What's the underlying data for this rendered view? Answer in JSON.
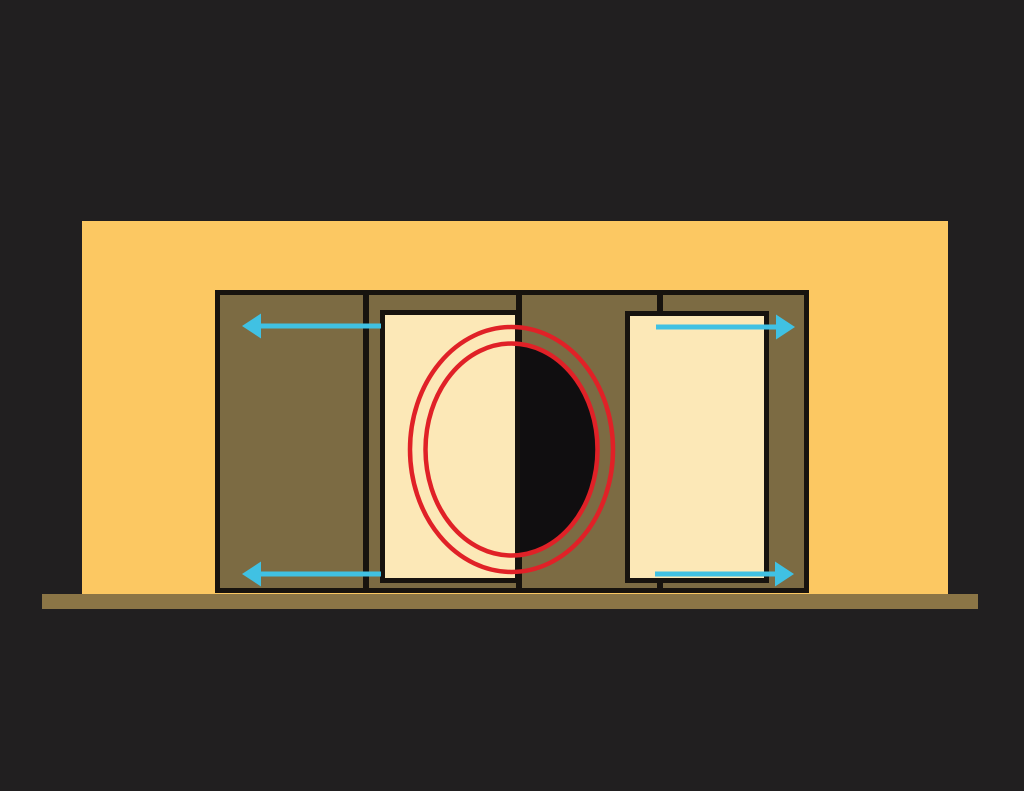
{
  "scene": {
    "canvas": {
      "width": 1024,
      "height": 791,
      "background": "#211f20"
    },
    "palette": {
      "background": "#211f20",
      "wall": "#fcc862",
      "outline": "#17130e",
      "frame_fill": "#7c6b43",
      "panel_fill": "#fce8b7",
      "floor": "#8b7546",
      "gap_shadow": "#100e10",
      "ring": "#e02127",
      "arrow": "#40c1e3"
    },
    "wall": {
      "name": "wall",
      "x": 82,
      "y": 221,
      "w": 866,
      "h": 374
    },
    "floor": {
      "name": "floor",
      "x": 42,
      "y": 594,
      "w": 936,
      "h": 15
    },
    "frame": {
      "name": "door-frame",
      "x": 215,
      "y": 290,
      "w": 594,
      "h": 303,
      "border": 5
    },
    "dividers": [
      {
        "name": "frame-divider-1",
        "x": 363,
        "w": 6
      },
      {
        "name": "frame-divider-2",
        "x": 516,
        "w": 6
      },
      {
        "name": "frame-divider-3",
        "x": 657,
        "w": 6
      }
    ],
    "gap_shadow": {
      "name": "open-gap-shadow",
      "cx": 511.5,
      "cy": 449.5,
      "rx": 86,
      "ry": 106
    },
    "panels": [
      {
        "name": "left-door-panel",
        "x": 380,
        "y": 310,
        "w": 140,
        "h": 273,
        "border": 5
      },
      {
        "name": "right-door-panel",
        "x": 625,
        "y": 311,
        "w": 144,
        "h": 272,
        "border": 5
      }
    ],
    "rings": {
      "cx": 511.5,
      "cy": 449.5,
      "stroke_width": 4.5,
      "outer": {
        "name": "highlight-ring-outer",
        "rx": 101.5,
        "ry": 122.5
      },
      "inner": {
        "name": "highlight-ring-inner",
        "rx": 86,
        "ry": 106
      }
    },
    "arrow_style": {
      "line_width": 5,
      "head_length": 19,
      "head_half_height": 12.5
    },
    "arrows": [
      {
        "name": "slide-arrow-top-left",
        "tail_x": 381,
        "tip_x": 242,
        "y": 326
      },
      {
        "name": "slide-arrow-bottom-left",
        "tail_x": 381,
        "tip_x": 242,
        "y": 574
      },
      {
        "name": "slide-arrow-top-right",
        "tail_x": 656,
        "tip_x": 795,
        "y": 327
      },
      {
        "name": "slide-arrow-bottom-right",
        "tail_x": 655,
        "tip_x": 794,
        "y": 574
      }
    ]
  }
}
